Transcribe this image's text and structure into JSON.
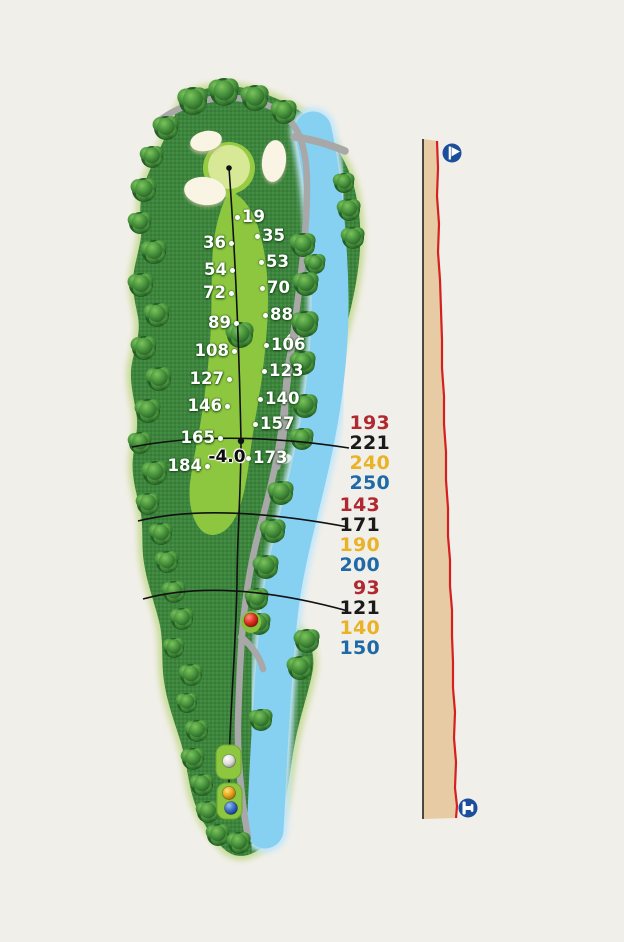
{
  "background": "#f1efe9",
  "hole_map": {
    "elevation_marker": {
      "label": "-4.0",
      "x": 227,
      "y": 457
    },
    "yardage_markers_left": [
      {
        "label": "36",
        "x": 231,
        "y": 243
      },
      {
        "label": "54",
        "x": 232,
        "y": 270
      },
      {
        "label": "72",
        "x": 231,
        "y": 293
      },
      {
        "label": "89",
        "x": 236,
        "y": 323
      },
      {
        "label": "108",
        "x": 234,
        "y": 351
      },
      {
        "label": "127",
        "x": 229,
        "y": 379
      },
      {
        "label": "146",
        "x": 227,
        "y": 406
      },
      {
        "label": "165",
        "x": 220,
        "y": 438
      },
      {
        "label": "184",
        "x": 207,
        "y": 466
      }
    ],
    "yardage_markers_right": [
      {
        "label": "19",
        "x": 237,
        "y": 217
      },
      {
        "label": "35",
        "x": 257,
        "y": 236
      },
      {
        "label": "53",
        "x": 261,
        "y": 262
      },
      {
        "label": "70",
        "x": 262,
        "y": 288
      },
      {
        "label": "88",
        "x": 265,
        "y": 315
      },
      {
        "label": "106",
        "x": 266,
        "y": 345
      },
      {
        "label": "123",
        "x": 264,
        "y": 371
      },
      {
        "label": "140",
        "x": 260,
        "y": 399
      },
      {
        "label": "157",
        "x": 255,
        "y": 424
      },
      {
        "label": "173",
        "x": 248,
        "y": 458
      }
    ],
    "features": {
      "green_color": "#d7e897",
      "fairway_color": "#8dc63f",
      "rough_color": "#3c853c",
      "water_color": "#86d0f2",
      "bunker_color": "#f9f4e3",
      "cart_path_color": "#a8a8a8"
    },
    "tee_balls": [
      {
        "name": "red-tee-ball",
        "color": "#e03020"
      },
      {
        "name": "white-tee-ball",
        "color": "#ffffff"
      },
      {
        "name": "gold-tee-ball",
        "color": "#e8a71f"
      },
      {
        "name": "blue-tee-ball",
        "color": "#3b6cc7"
      }
    ]
  },
  "tee_colors": {
    "red": "#b02830",
    "black": "#1a1a1a",
    "yellow": "#e9b227",
    "blue": "#1f6aa6"
  },
  "distance_groups": [
    {
      "distances": [
        {
          "value": "193",
          "tee": "red"
        },
        {
          "value": "221",
          "tee": "black"
        },
        {
          "value": "240",
          "tee": "yellow"
        },
        {
          "value": "250",
          "tee": "blue"
        }
      ]
    },
    {
      "distances": [
        {
          "value": "143",
          "tee": "red"
        },
        {
          "value": "171",
          "tee": "black"
        },
        {
          "value": "190",
          "tee": "yellow"
        },
        {
          "value": "200",
          "tee": "blue"
        }
      ]
    },
    {
      "distances": [
        {
          "value": "93",
          "tee": "red"
        },
        {
          "value": "121",
          "tee": "black"
        },
        {
          "value": "140",
          "tee": "yellow"
        },
        {
          "value": "150",
          "tee": "blue"
        }
      ]
    }
  ],
  "elevation_profile": {
    "ground_color": "#e6cba4",
    "line_color": "#d42020",
    "start_icon": "green-flag-icon",
    "end_icon": "tee-icon"
  }
}
